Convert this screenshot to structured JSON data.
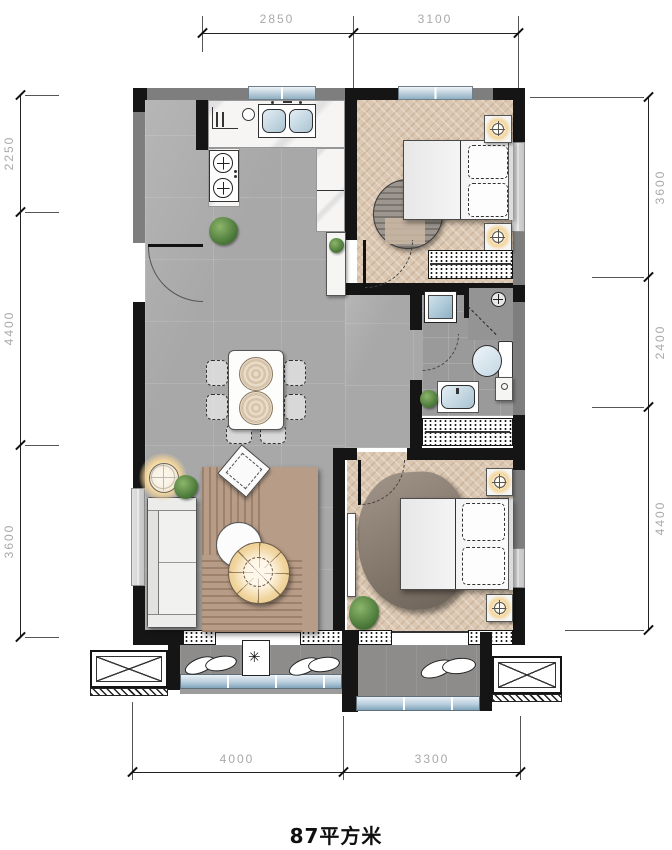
{
  "caption": {
    "area": "87平方米"
  },
  "dimensions": {
    "top": [
      "2850",
      "3100"
    ],
    "left": [
      "2250",
      "4400",
      "3600"
    ],
    "right": [
      "3600",
      "2400",
      "4400"
    ],
    "bottom": [
      "4000",
      "3300"
    ]
  },
  "colors": {
    "wall_primary": "#151515",
    "wall_secondary": "#7e7e7e",
    "window_glass": "#a9c3d5",
    "floor_tile": "#a8a8a8",
    "floor_wood": "#dcc8b2",
    "floor_balcony": "#8e8c8a",
    "rug_living": "#b79c87",
    "lamp_glow": "#f3d59b",
    "plant": "#4f7d3c",
    "dimension_text": "#a8a8a8",
    "caption_text": "#101010"
  }
}
